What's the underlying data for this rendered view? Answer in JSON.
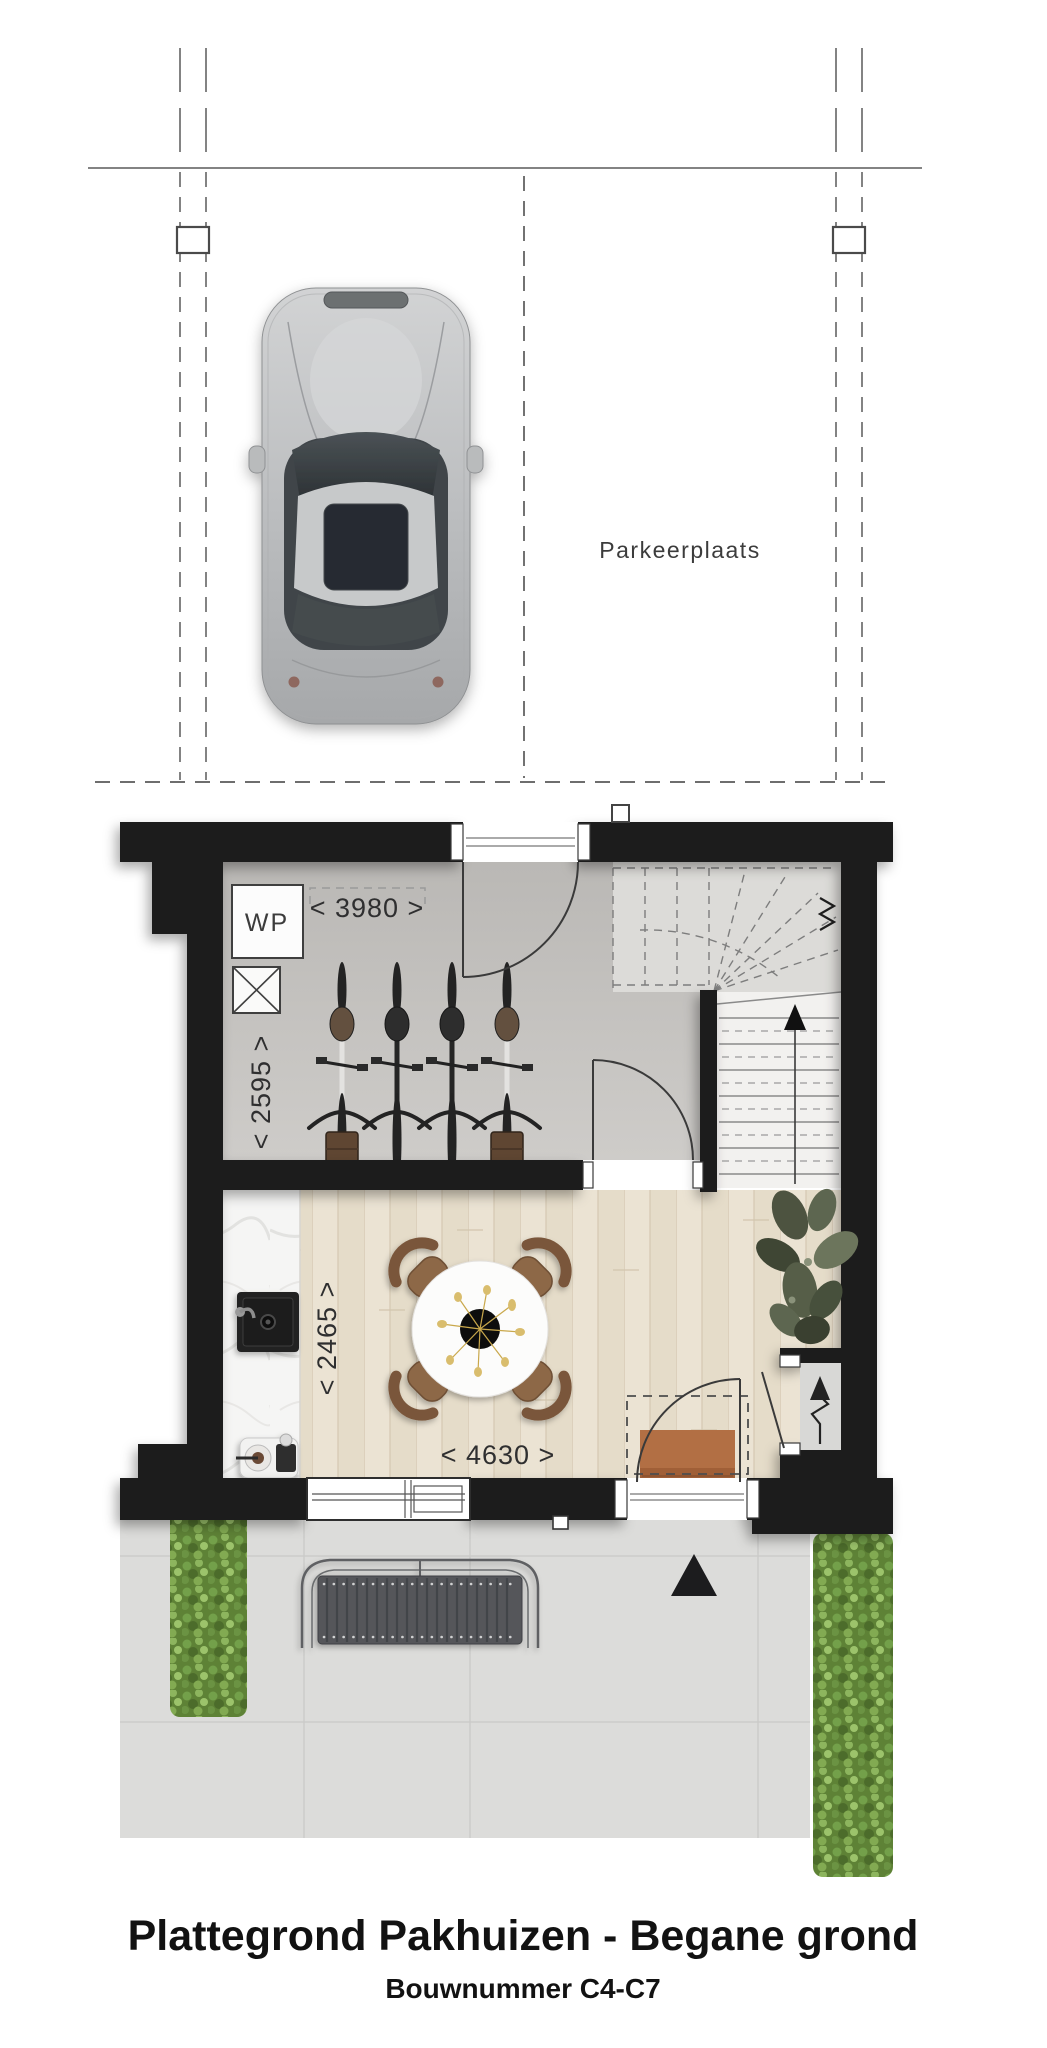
{
  "parking": {
    "label": "Parkeerplaats"
  },
  "plan": {
    "wp_label": "WP",
    "dims": {
      "storage_width": "< 3980 >",
      "storage_depth": "< 2595 >",
      "living_depth": "< 2465 >",
      "living_width": "< 4630 >"
    }
  },
  "icons": {
    "stair_direction": "up-arrow",
    "electricity": "lightning-arrow",
    "entrance": "up-triangle"
  },
  "footer": {
    "title": "Plattegrond Pakhuizen - Begane grond",
    "subtitle": "Bouwnummer C4-C7"
  },
  "colors": {
    "wall": "#1d1d1f",
    "storage_floor": "#c6c3c0",
    "wood_floor": "#eae2d2",
    "terrace": "#dcdcda",
    "hedge": "#5e8236",
    "mat": "#b26f44",
    "text": "#2f2f30"
  }
}
